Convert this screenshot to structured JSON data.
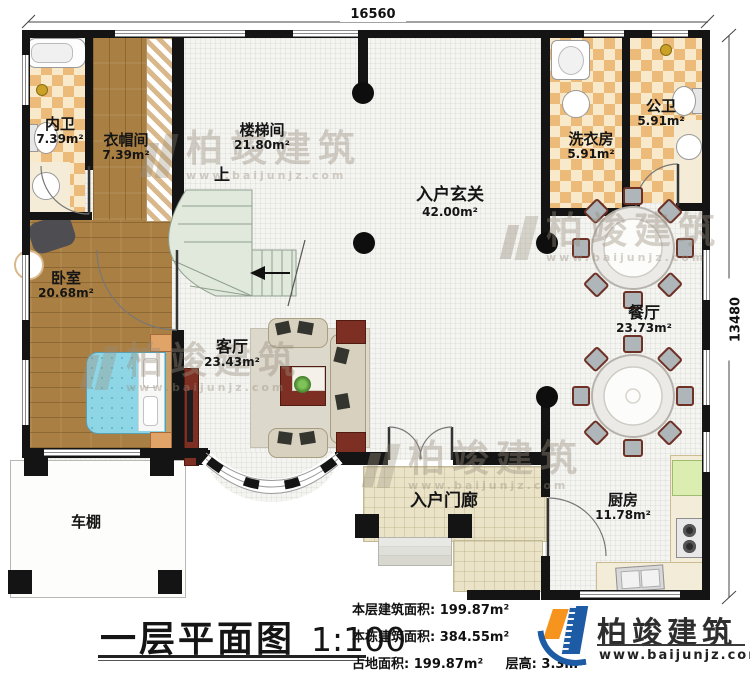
{
  "dimensions": {
    "top": "16560",
    "right": "13480"
  },
  "rooms": {
    "neiwei": {
      "name": "内卫",
      "area": "7.39m²"
    },
    "yimaojian": {
      "name": "衣帽间",
      "area": "7.39m²"
    },
    "loutijian": {
      "name": "楼梯间",
      "area": "21.80m²"
    },
    "xuanguan": {
      "name": "入户玄关",
      "area": "42.00m²"
    },
    "xiyifang": {
      "name": "洗衣房",
      "area": "5.91m²"
    },
    "gongwei": {
      "name": "公卫",
      "area": "5.91m²"
    },
    "canting": {
      "name": "餐厅",
      "area": "23.73m²"
    },
    "woshi": {
      "name": "卧室",
      "area": "20.68m²"
    },
    "keting": {
      "name": "客厅",
      "area": "23.43m²"
    },
    "chufang": {
      "name": "厨房",
      "area": "11.78m²"
    },
    "rumenlang": {
      "name": "入户门廊"
    },
    "chepeng": {
      "name": "车棚"
    }
  },
  "stair": {
    "up": "上"
  },
  "footer": {
    "title": "一层平面图",
    "scale": "1:100",
    "stats": [
      {
        "label": "本层建筑面积:",
        "value": "199.87m²"
      },
      {
        "label": "本栋建筑面积:",
        "value": "384.55m²"
      },
      {
        "label": "占地面积:",
        "value": "199.87m²",
        "label2": "层高:",
        "value2": "3.3m"
      }
    ],
    "logo": {
      "name": "柏竣建筑",
      "url": "www.baijunjz.com"
    }
  },
  "watermark": {
    "text": "柏竣建筑",
    "url": "www.baijunjz.com"
  },
  "colors": {
    "wall": "#141414",
    "logo_blue": "#1d5ca4",
    "logo_orange": "#f7941e",
    "accent_red": "#7e2f24",
    "stair": "#e1e9dd"
  }
}
